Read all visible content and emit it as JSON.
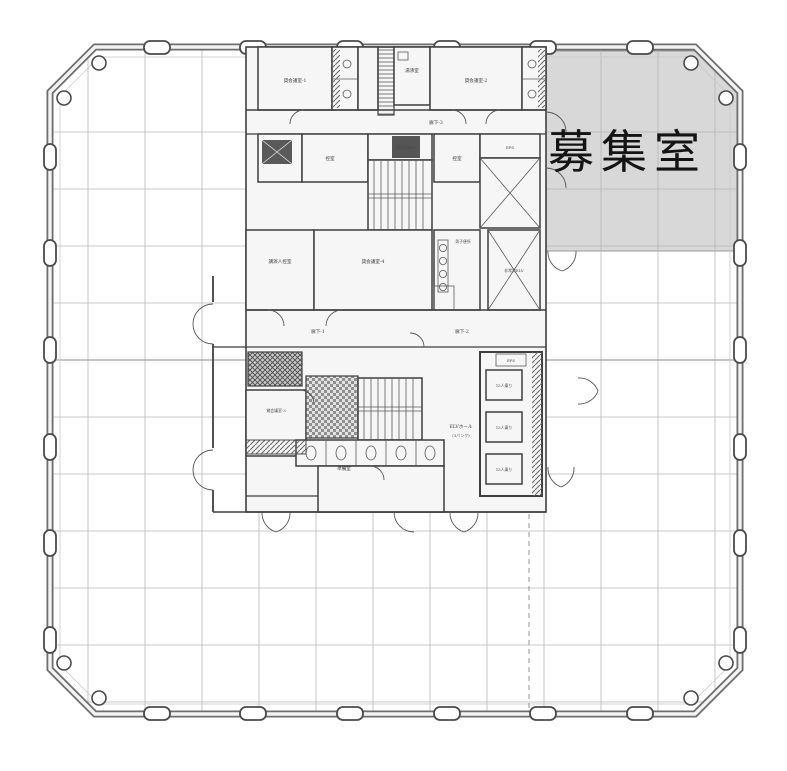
{
  "plan": {
    "highlight": {
      "label": "募集室",
      "fill": "#d8d8d8"
    },
    "rooms": {
      "meeting1": {
        "label": "貸会議室-1"
      },
      "meeting2": {
        "label": "貸会議室-2"
      },
      "meeting3": {
        "label": "貸会議室-3"
      },
      "meeting4": {
        "label": "貸会議室-4"
      },
      "speaker_room": {
        "label": "講演人控室"
      },
      "waiting1": {
        "label": "控室"
      },
      "waiting2": {
        "label": "控室"
      },
      "kitchenette": {
        "label": "湯沸室"
      },
      "luggage_elv": {
        "label": "荷物用ELV"
      },
      "mens_wc": {
        "label": "男子便所"
      },
      "emergency_elv": {
        "label": "非常用ELV"
      },
      "eps": {
        "label": "EPS"
      },
      "elv_hall_line1": {
        "label": "ELVホール"
      },
      "elv_hall_line2": {
        "label": "(3バンク)"
      },
      "elv_car": {
        "label": "15人乗り"
      },
      "prep_room": {
        "label": "準備室"
      }
    },
    "corridors": {
      "c1": {
        "label": "廊下-1"
      },
      "c2": {
        "label": "廊下-2"
      },
      "c3": {
        "label": "廊下-3"
      }
    },
    "colors": {
      "highlight": "#d8d8d8",
      "line": "#3f3f3f",
      "grid": "#b6b6b6",
      "wall": "#6e6e6e",
      "text": "#141414"
    }
  }
}
